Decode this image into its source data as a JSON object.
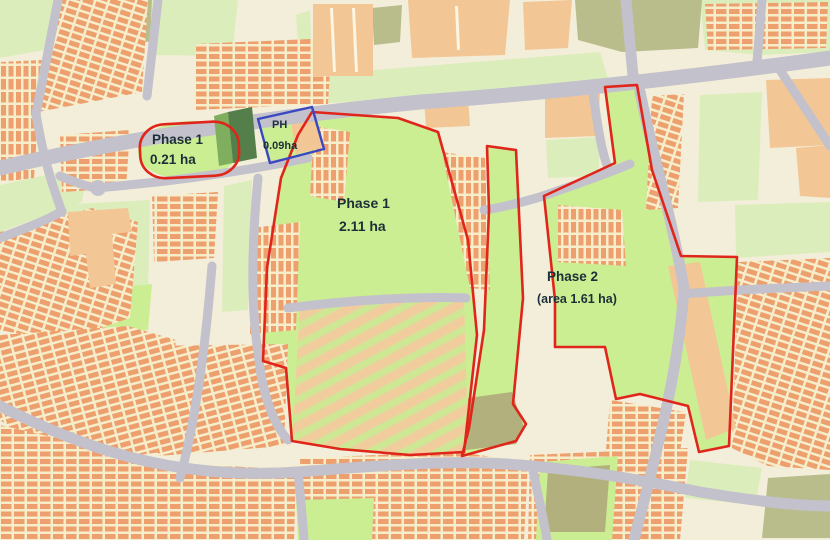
{
  "figure": {
    "title": "Development phasing plan map",
    "labels": {
      "phase1_site": {
        "line1": "Phase 1",
        "line2": "0.21 ha"
      },
      "ph_site": {
        "line1": "PH",
        "line2": "0.09ha"
      },
      "phase1_main": {
        "line1": "Phase 1",
        "line2": "2.11 ha"
      },
      "phase2": {
        "line1": "Phase 2",
        "line2": "(area 1.61 ha)"
      }
    },
    "colors": {
      "boundary_red": "#e0251b",
      "boundary_blue": "#3a47c0",
      "open_space_green": "#cbee92",
      "building_orange": "#eda06e",
      "building_peach": "#f3c795",
      "road_gray": "#c3c1cc",
      "background_cream": "#f3eed9",
      "label_text": "#1c2f38"
    }
  }
}
